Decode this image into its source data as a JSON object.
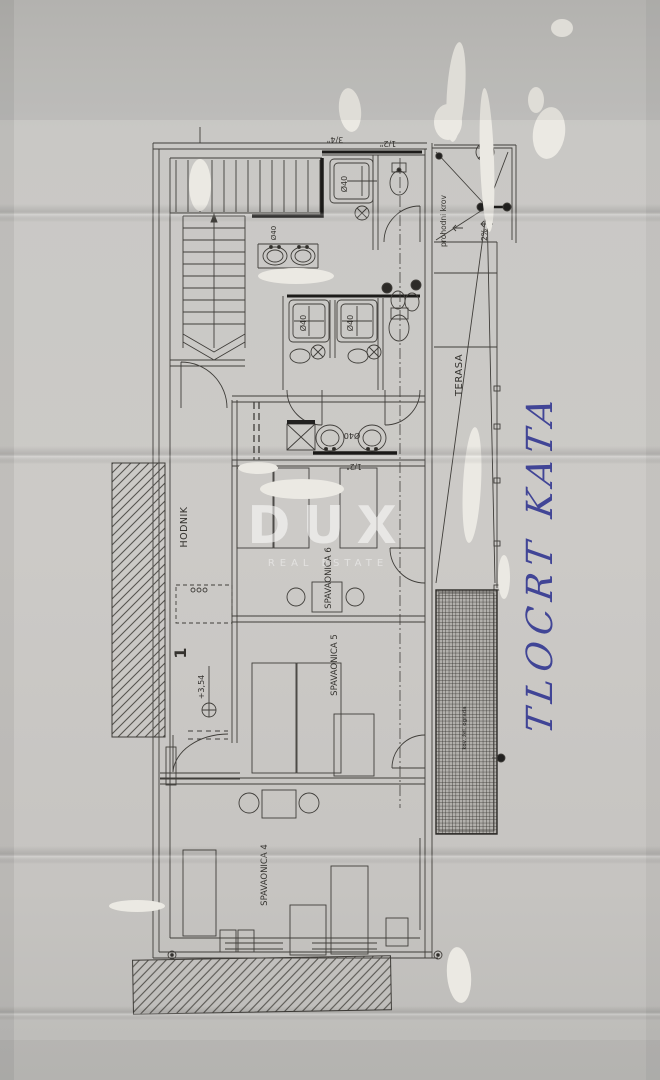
{
  "plan": {
    "rooms": {
      "hodnik": "HODNIK",
      "terasa": "TERASA",
      "spavaonica4": "SPAVAONICA 4",
      "spavaonica5": "SPAVAONICA 5",
      "spavaonica6": "SPAVAONICA 6"
    },
    "annotations": {
      "walkable_roof": "prohodni krov",
      "slope": "2%",
      "elevation": "+3,54",
      "stair_number": "1",
      "pipe_half": "1/2\"",
      "pipe_three_quarter": "3/4\"",
      "drain_diameter": "Ø40",
      "railing_note": "kov. žel. ograda"
    }
  },
  "watermark": {
    "brand": "DUX",
    "tagline": "REAL ESTATE"
  },
  "handwriting": {
    "note": "TLOCRT KATA"
  },
  "colors": {
    "paper": "#c9c7c4",
    "ink": "#3e3c38",
    "pen_blue": "#2e3390",
    "whiteout": "#ebe9e3"
  }
}
